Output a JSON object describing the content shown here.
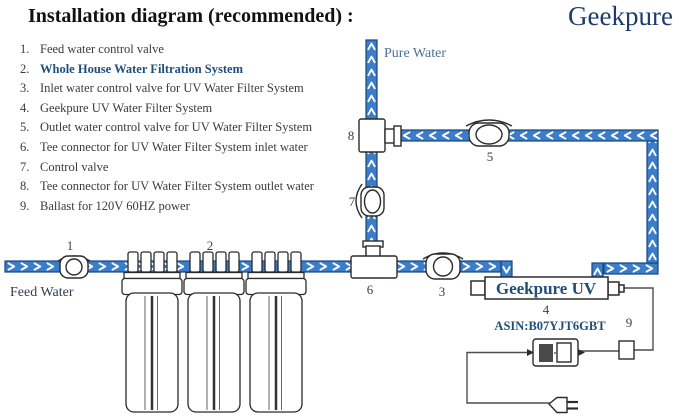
{
  "header": {
    "title": "Installation diagram (recommended) :",
    "brand": "Geekpure"
  },
  "legend": {
    "items": [
      {
        "num": "1.",
        "text": "Feed water control valve"
      },
      {
        "num": "2.",
        "text": "Whole House Water Filtration System"
      },
      {
        "num": "3.",
        "text": "Inlet water control valve for UV Water Filter System"
      },
      {
        "num": "4.",
        "text": "Geekpure UV Water Filter System"
      },
      {
        "num": "5.",
        "text": "Outlet water control valve for UV Water Filter System"
      },
      {
        "num": "6.",
        "text": "Tee connector for UV Water Filter System  inlet water"
      },
      {
        "num": "7.",
        "text": "Control valve"
      },
      {
        "num": "8.",
        "text": "Tee connector for UV Water Filter System  outlet water"
      },
      {
        "num": "9.",
        "text": "Ballast for 120V 60HZ power"
      }
    ]
  },
  "diagram": {
    "labels": {
      "pure_water": "Pure Water",
      "feed_water": "Feed Water",
      "uv_unit": "Geekpure UV",
      "asin": "ASIN:B07YJT6GBT",
      "n1": "1",
      "n2": "2",
      "n3": "3",
      "n4": "4",
      "n5": "5",
      "n6": "6",
      "n7": "7",
      "n8": "8",
      "n9": "9"
    },
    "colors": {
      "pipe_fill": "#3b7dc8",
      "pipe_border": "#16477e",
      "arrow": "#ffffff",
      "brand_blue": "#1f3a6e",
      "highlight_blue": "#1f4e79",
      "flow_label_blue": "#4a7296",
      "line_dark": "#2b2b2b"
    }
  }
}
